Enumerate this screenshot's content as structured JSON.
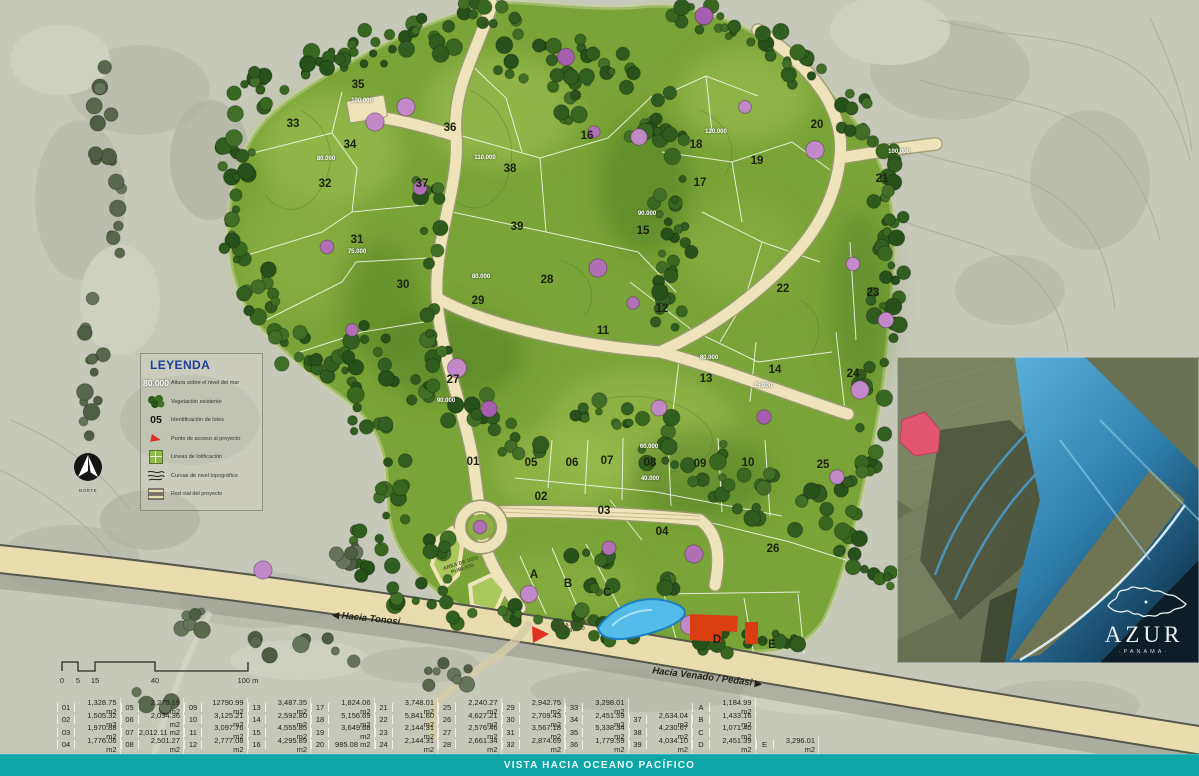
{
  "legend": {
    "title": "LEYENDA",
    "items": [
      {
        "key": "80.000",
        "label": "Altura sobre el nivel del mar"
      },
      {
        "key": "",
        "label": "Vegetación existente"
      },
      {
        "key": "05",
        "label": "Identificación de lotes"
      },
      {
        "key": "",
        "label": "Punto de acceso al proyecto"
      },
      {
        "key": "",
        "label": "Lineas de lotificación"
      },
      {
        "key": "",
        "label": "Curvas de nivel topográfico"
      },
      {
        "key": "",
        "label": "Red vial del proyecto"
      }
    ]
  },
  "compass": {
    "label": "NORTE"
  },
  "scalebar": {
    "ticks": [
      {
        "t": "0",
        "x": 4
      },
      {
        "t": "5",
        "x": 20
      },
      {
        "t": "15",
        "x": 37
      },
      {
        "t": "40",
        "x": 97
      },
      {
        "t": "100 m",
        "x": 190
      }
    ]
  },
  "roads": {
    "tonosi": "Hacia Tonosi",
    "venado": "Hacia Venado / Pedasi"
  },
  "map": {
    "lots": [
      {
        "id": "35",
        "x": 358,
        "y": 85
      },
      {
        "id": "33",
        "x": 293,
        "y": 124
      },
      {
        "id": "34",
        "x": 350,
        "y": 145
      },
      {
        "id": "32",
        "x": 325,
        "y": 184
      },
      {
        "id": "31",
        "x": 357,
        "y": 240
      },
      {
        "id": "36",
        "x": 450,
        "y": 128
      },
      {
        "id": "37",
        "x": 422,
        "y": 184
      },
      {
        "id": "38",
        "x": 510,
        "y": 169
      },
      {
        "id": "39",
        "x": 517,
        "y": 227
      },
      {
        "id": "16",
        "x": 587,
        "y": 136
      },
      {
        "id": "15",
        "x": 643,
        "y": 231
      },
      {
        "id": "18",
        "x": 696,
        "y": 145
      },
      {
        "id": "20",
        "x": 817,
        "y": 125
      },
      {
        "id": "19",
        "x": 757,
        "y": 161
      },
      {
        "id": "17",
        "x": 700,
        "y": 183
      },
      {
        "id": "21",
        "x": 882,
        "y": 179
      },
      {
        "id": "22",
        "x": 783,
        "y": 289
      },
      {
        "id": "23",
        "x": 873,
        "y": 293
      },
      {
        "id": "12",
        "x": 662,
        "y": 309
      },
      {
        "id": "11",
        "x": 603,
        "y": 331
      },
      {
        "id": "30",
        "x": 403,
        "y": 285
      },
      {
        "id": "29",
        "x": 478,
        "y": 301
      },
      {
        "id": "28",
        "x": 547,
        "y": 280
      },
      {
        "id": "27",
        "x": 453,
        "y": 380
      },
      {
        "id": "13",
        "x": 706,
        "y": 379
      },
      {
        "id": "14",
        "x": 775,
        "y": 370
      },
      {
        "id": "24",
        "x": 853,
        "y": 374
      },
      {
        "id": "01",
        "x": 473,
        "y": 462
      },
      {
        "id": "05",
        "x": 531,
        "y": 463
      },
      {
        "id": "06",
        "x": 572,
        "y": 463
      },
      {
        "id": "07",
        "x": 607,
        "y": 461
      },
      {
        "id": "08",
        "x": 650,
        "y": 463
      },
      {
        "id": "09",
        "x": 700,
        "y": 464
      },
      {
        "id": "10",
        "x": 748,
        "y": 463
      },
      {
        "id": "25",
        "x": 823,
        "y": 465
      },
      {
        "id": "02",
        "x": 541,
        "y": 497
      },
      {
        "id": "03",
        "x": 604,
        "y": 511
      },
      {
        "id": "04",
        "x": 662,
        "y": 532
      },
      {
        "id": "26",
        "x": 773,
        "y": 549
      },
      {
        "id": "A",
        "x": 534,
        "y": 575
      },
      {
        "id": "B",
        "x": 568,
        "y": 584
      },
      {
        "id": "C",
        "x": 607,
        "y": 593
      },
      {
        "id": "D",
        "x": 717,
        "y": 640
      },
      {
        "id": "E",
        "x": 772,
        "y": 645
      }
    ],
    "elevations": [
      {
        "t": "100.000",
        "x": 362,
        "y": 101
      },
      {
        "t": "80.000",
        "x": 326,
        "y": 159
      },
      {
        "t": "110.000",
        "x": 485,
        "y": 158
      },
      {
        "t": "75.000",
        "x": 357,
        "y": 252
      },
      {
        "t": "90.000",
        "x": 647,
        "y": 214
      },
      {
        "t": "120.000",
        "x": 716,
        "y": 132
      },
      {
        "t": "100.000",
        "x": 899,
        "y": 152
      },
      {
        "t": "80.000",
        "x": 481,
        "y": 277
      },
      {
        "t": "80.000",
        "x": 709,
        "y": 358
      },
      {
        "t": "90.000",
        "x": 446,
        "y": 401
      },
      {
        "t": "60.000",
        "x": 649,
        "y": 447
      },
      {
        "t": "40.000",
        "x": 650,
        "y": 479
      },
      {
        "t": "75.000",
        "x": 763,
        "y": 386
      }
    ],
    "public_areas": [
      {
        "t": "AREA DE USO PUBLICO",
        "x": 462,
        "y": 567,
        "rot": -18
      },
      {
        "t": "AREA DE USO PUBLICO",
        "x": 573,
        "y": 628,
        "rot": -10
      }
    ]
  },
  "inset": {
    "brand": "AZUR",
    "sub": "·PANAMA·"
  },
  "footer": {
    "text": "VISTA HACIA OCEANO PACÍFICO"
  },
  "table": {
    "rows": [
      [
        {
          "id": "01",
          "a": "1,328.75 m2"
        },
        {
          "id": "05",
          "a": "2,278.19 m2"
        },
        {
          "id": "09",
          "a": "12790.99 m2"
        },
        {
          "id": "13",
          "a": "3,487.35 m2"
        },
        {
          "id": "17",
          "a": "1,824.06 m2"
        },
        {
          "id": "21",
          "a": "3,748.01 m2"
        },
        {
          "id": "25",
          "a": "2,240.27 m2"
        },
        {
          "id": "29",
          "a": "2,942.75 m2"
        },
        {
          "id": "33",
          "a": "3,298.01 m2"
        },
        {},
        {
          "id": "A",
          "a": "1,184.99 m2"
        },
        {}
      ],
      [
        {
          "id": "02",
          "a": "1,505.32 m2"
        },
        {
          "id": "06",
          "a": "2,034.36 m2"
        },
        {
          "id": "10",
          "a": "3,125.21 m2"
        },
        {
          "id": "14",
          "a": "2,592.80 m2"
        },
        {
          "id": "18",
          "a": "5,156.69 m2"
        },
        {
          "id": "22",
          "a": "5,841.60 m2"
        },
        {
          "id": "26",
          "a": "4,627.21 m2"
        },
        {
          "id": "30",
          "a": "2,709.43 m2"
        },
        {
          "id": "34",
          "a": "2,451.59 m2"
        },
        {
          "id": "37",
          "a": "2,634.04 m2"
        },
        {
          "id": "B",
          "a": "1,433.16 m2"
        },
        {}
      ],
      [
        {
          "id": "03",
          "a": "1,970.88 m2"
        },
        {
          "id": "07",
          "a": "2,012.11 m2"
        },
        {
          "id": "11",
          "a": "3,097.76 m2"
        },
        {
          "id": "15",
          "a": "4,555.85 m2"
        },
        {
          "id": "19",
          "a": "3,649.68 m2"
        },
        {
          "id": "23",
          "a": "2,144.31 m2"
        },
        {
          "id": "27",
          "a": "2,576.46 m2"
        },
        {
          "id": "31",
          "a": "3,567.18 m2"
        },
        {
          "id": "35",
          "a": "5,338.34 m2"
        },
        {
          "id": "38",
          "a": "4,230.67 m2"
        },
        {
          "id": "C",
          "a": "1,071.40 m2"
        },
        {}
      ],
      [
        {
          "id": "04",
          "a": "1,776.06 m2"
        },
        {
          "id": "08",
          "a": "2,501.27 m2"
        },
        {
          "id": "12",
          "a": "2,777.08 m2"
        },
        {
          "id": "16",
          "a": "4,295.89 m2"
        },
        {
          "id": "20",
          "a": "985.08 m2"
        },
        {
          "id": "24",
          "a": "2,144.31 m2"
        },
        {
          "id": "28",
          "a": "2,661.34 m2"
        },
        {
          "id": "32",
          "a": "2,874.69 m2"
        },
        {
          "id": "36",
          "a": "1,779.59 m2"
        },
        {
          "id": "39",
          "a": "4,034.10 m2"
        },
        {
          "id": "D",
          "a": "2,451.39 m2"
        },
        {
          "id": "E",
          "a": "3,296.01 m2"
        }
      ]
    ]
  }
}
